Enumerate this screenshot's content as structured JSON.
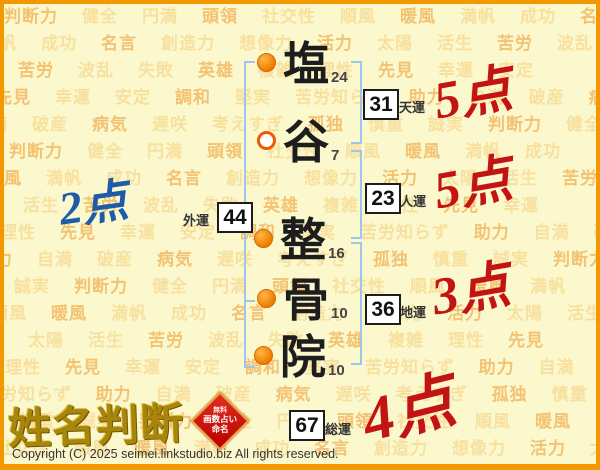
{
  "page": {
    "site_logo": "姓名判断",
    "copyright": "Copyright (C) 2025 seimei.linkstudio.biz All rights reserved."
  },
  "colors": {
    "frame_orange": "#F39800",
    "background": "#FBF8CE",
    "word_orange": "#F3C272",
    "word_light": "#F8E09E",
    "bracket_blue": "#9CC6EA",
    "score_red": "#C31414",
    "score_blue": "#1C5CA8",
    "logo_gold": "#A8860C",
    "stamp_red": "#C00000",
    "bullet_orange": "#EF7E00"
  },
  "name": {
    "full": "塩谷整骨院",
    "chars": [
      {
        "char": "塩",
        "strokes": "24",
        "bullet": "filled"
      },
      {
        "char": "谷",
        "strokes": "7",
        "bullet": "hollow"
      },
      {
        "char": "整",
        "strokes": "16",
        "bullet": "filled"
      },
      {
        "char": "骨",
        "strokes": "10",
        "bullet": "filled"
      },
      {
        "char": "院",
        "strokes": "10",
        "bullet": "filled"
      }
    ]
  },
  "fortunes": [
    {
      "id": "tenun",
      "label": "天運",
      "value": "31",
      "score": "5点"
    },
    {
      "id": "jinun",
      "label": "人運",
      "value": "23",
      "score": "5点"
    },
    {
      "id": "gaiun",
      "label": "外運",
      "value": "44",
      "score": "2点"
    },
    {
      "id": "chiun",
      "label": "地運",
      "value": "36",
      "score": "3点"
    },
    {
      "id": "souun",
      "label": "総運",
      "value": "67",
      "score": "4点"
    }
  ],
  "stamp": {
    "lines": [
      "無料",
      "画数占い",
      "命名"
    ]
  },
  "background": {
    "words": [
      "判断力",
      "健全",
      "円満",
      "頭領",
      "社交性",
      "順風",
      "暖風",
      "満帆",
      "成功",
      "名言",
      "創造力",
      "想像力",
      "活力",
      "太陽",
      "活生",
      "苦労",
      "波乱",
      "失敗",
      "英雄",
      "複雑",
      "理性",
      "先見",
      "幸運",
      "安定",
      "調和",
      "堅実",
      "苦労知らず",
      "助力",
      "自満",
      "破産",
      "病気",
      "遅咲",
      "考えすぎ",
      "孤独",
      "慎重",
      "誠実"
    ],
    "rows": 17,
    "row_height": 27
  }
}
